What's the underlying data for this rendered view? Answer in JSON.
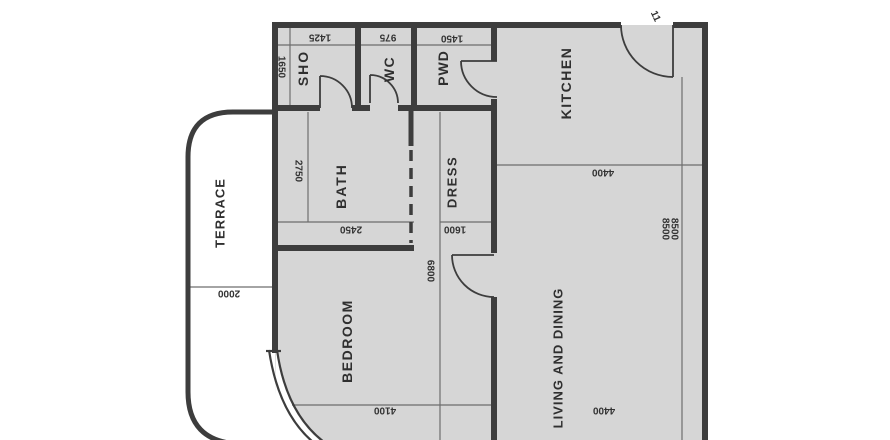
{
  "plan": {
    "title": "apartment-floor-plan",
    "rooms": {
      "sho": {
        "label": "SHO"
      },
      "wc": {
        "label": "WC"
      },
      "pwd": {
        "label": "PWD"
      },
      "kitchen": {
        "label": "KITCHEN"
      },
      "bath": {
        "label": "BATH"
      },
      "dress": {
        "label": "DRESS"
      },
      "terrace": {
        "label": "TERRACE"
      },
      "bedroom": {
        "label": "BEDROOM"
      },
      "living": {
        "label": "LIVING AND DINING"
      }
    },
    "dimensions": {
      "sho_width": "1425",
      "wc_width": "975",
      "pwd_width": "1450",
      "sho_depth": "1650",
      "bath_depth": "2750",
      "bath_width": "2450",
      "dress_width": "1600",
      "hall_depth": "6800",
      "kitchen_width": "4400",
      "living_length_a": "8500",
      "living_length_b": "8500",
      "terrace_width": "2000",
      "bedroom_width": "4100",
      "living_width": "4400",
      "corner_note": "11"
    },
    "colors": {
      "wall": "#3d3d3d",
      "floor_fill": "#d6d6d6",
      "dimension_line": "#6e6e6e",
      "text": "#333333",
      "background": "#ffffff"
    }
  }
}
